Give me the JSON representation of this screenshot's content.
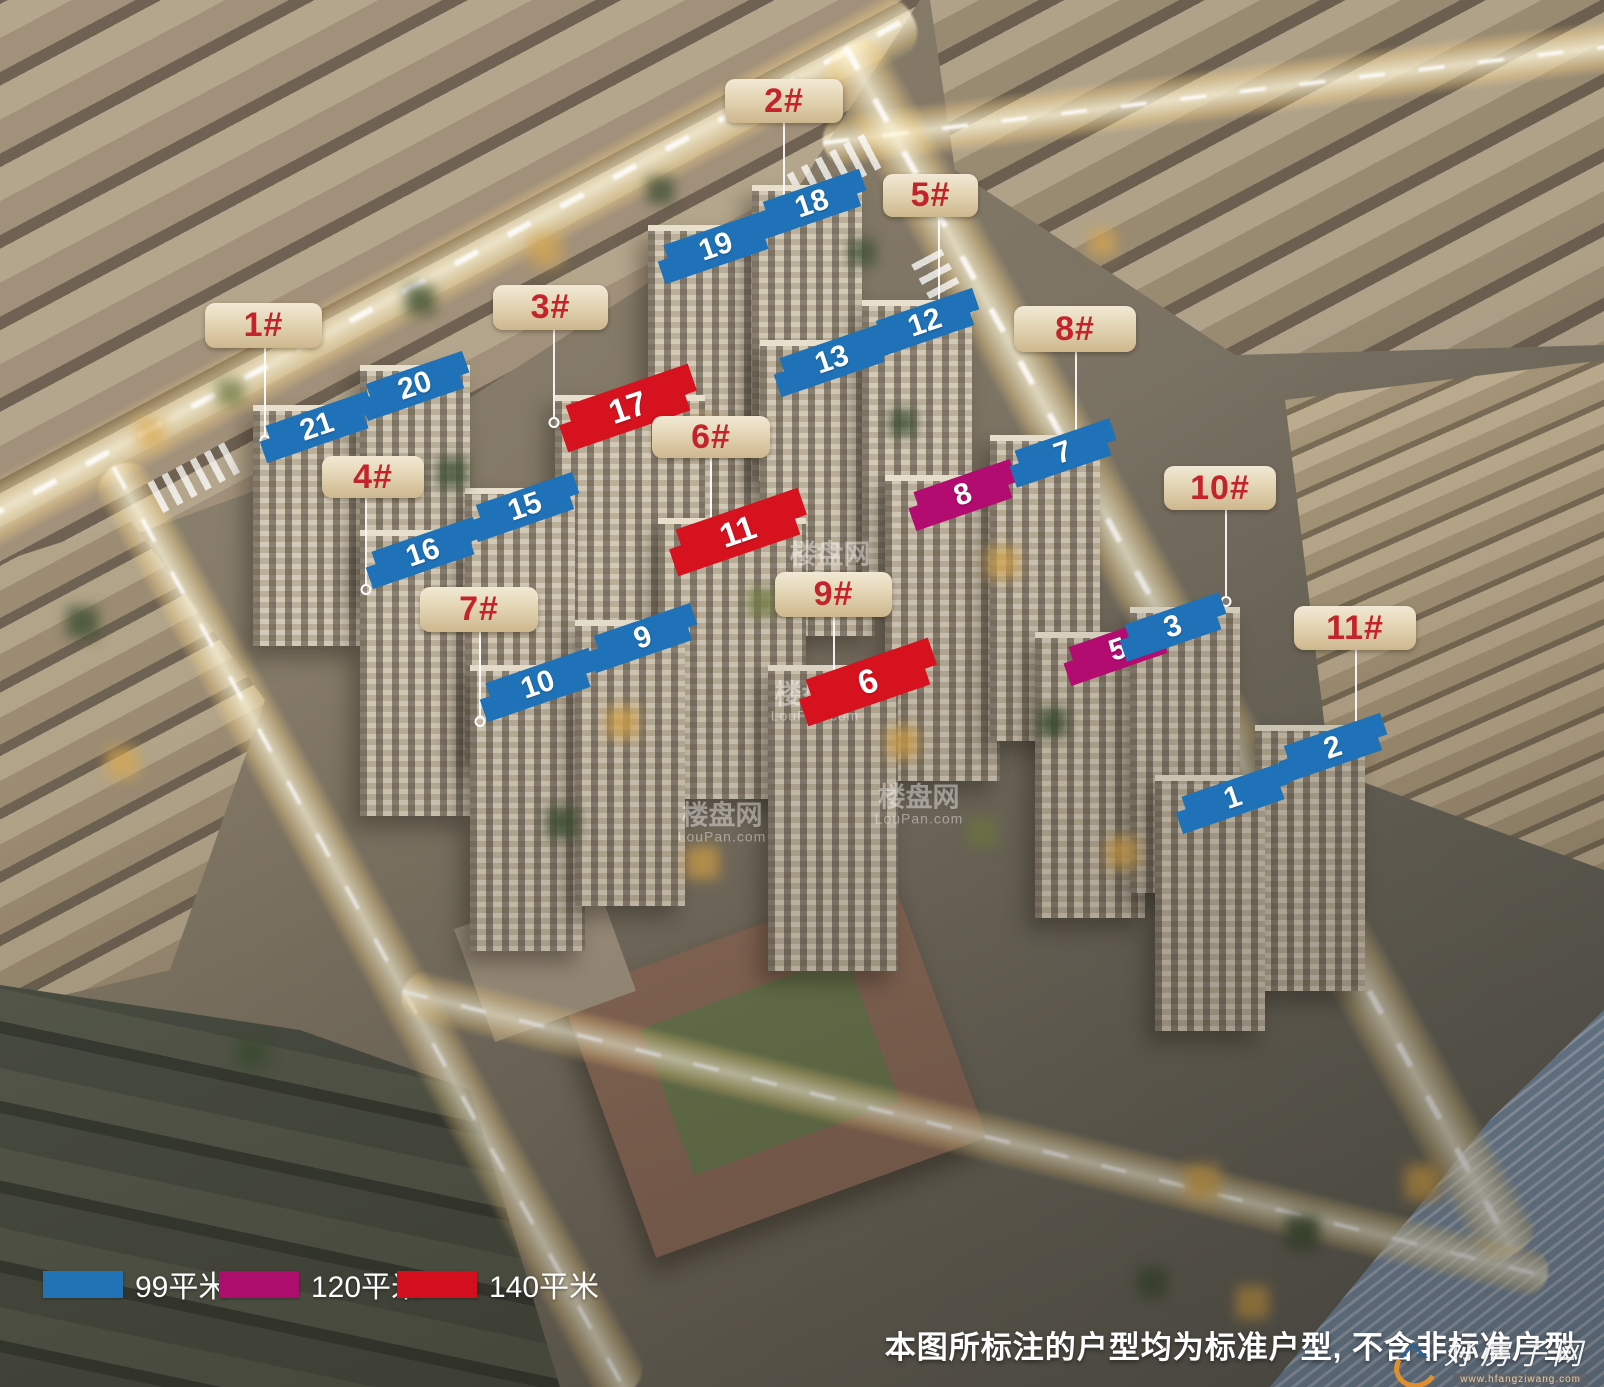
{
  "building_labels": [
    {
      "text": "1#"
    },
    {
      "text": "2#"
    },
    {
      "text": "3#"
    },
    {
      "text": "4#"
    },
    {
      "text": "5#"
    },
    {
      "text": "6#"
    },
    {
      "text": "7#"
    },
    {
      "text": "8#"
    },
    {
      "text": "9#"
    },
    {
      "text": "10#"
    },
    {
      "text": "11#"
    }
  ],
  "markers": [
    {
      "num": "21",
      "area": "99平米"
    },
    {
      "num": "20",
      "area": "99平米"
    },
    {
      "num": "19",
      "area": "99平米"
    },
    {
      "num": "18",
      "area": "99平米"
    },
    {
      "num": "17",
      "area": "140平米"
    },
    {
      "num": "16",
      "area": "99平米"
    },
    {
      "num": "15",
      "area": "99平米"
    },
    {
      "num": "13",
      "area": "99平米"
    },
    {
      "num": "12",
      "area": "99平米"
    },
    {
      "num": "11",
      "area": "140平米"
    },
    {
      "num": "10",
      "area": "99平米"
    },
    {
      "num": "9",
      "area": "99平米"
    },
    {
      "num": "8",
      "area": "120平米"
    },
    {
      "num": "7",
      "area": "99平米"
    },
    {
      "num": "6",
      "area": "140平米"
    },
    {
      "num": "5",
      "area": "120平米"
    },
    {
      "num": "3",
      "area": "99平米"
    },
    {
      "num": "2",
      "area": "99平米"
    },
    {
      "num": "1",
      "area": "99平米"
    }
  ],
  "legend": {
    "items": [
      {
        "label": "99平米",
        "color": "#2273b5"
      },
      {
        "label": "120平米",
        "color": "#ad0d6d"
      },
      {
        "label": "140平米",
        "color": "#d30f1e"
      }
    ]
  },
  "disclaimer": "本图所标注的户型均为标准户型, 不含非标准户型",
  "watermark": {
    "name": "楼盘网",
    "domain": "LouPan.com"
  },
  "logo": {
    "name": "好房子网",
    "url": "www.hfangziwang.com"
  }
}
